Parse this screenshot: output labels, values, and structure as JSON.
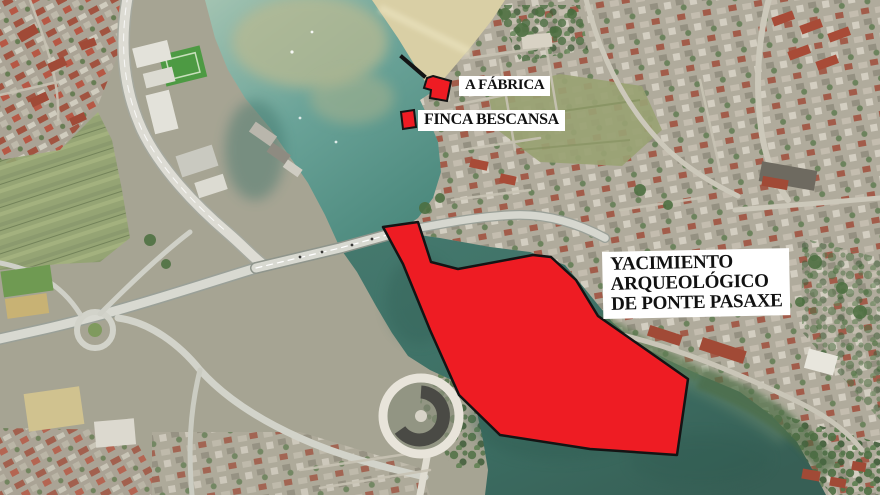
{
  "title": "Aerial map of Ponte Pasaxe area with archaeological annotations",
  "colors": {
    "site_red": "#ee1c23",
    "outline": "#141414",
    "label_bg": "#ffffff",
    "label_text": "#111111",
    "water_upper": "#6aa398",
    "water_deep": "#3c6e63",
    "sand": "#d9cfa5",
    "land": "#a8a795",
    "road": "#d8d9d1",
    "vegetation": "#4c6f40"
  },
  "labels": {
    "fabrica": {
      "text": "A FÁBRICA"
    },
    "finca": {
      "text": "FINCA BESCANSA"
    },
    "yacimiento": {
      "lines": [
        "YACIMIENTO",
        "ARQUEOLÓGICO",
        "DE PONTE PASAXE"
      ]
    }
  },
  "overlays": {
    "site": {
      "name": "Yacimiento arqueológico de Ponte Pasaxe",
      "points": "383,227 418,222 431,262 458,269 533,255 551,257 576,280 598,316 688,379 677,455 590,449 500,435 459,395 430,330 403,264"
    },
    "fabrica": {
      "name": "A Fábrica",
      "points": "433,76 451,81 447,101 430,98 431,90 424,88 427,78"
    },
    "finca": {
      "name": "Finca Bescansa",
      "points": "401,112 414,110 416,127 403,129"
    },
    "marker_line": {
      "points": "402,57 424,76"
    }
  }
}
